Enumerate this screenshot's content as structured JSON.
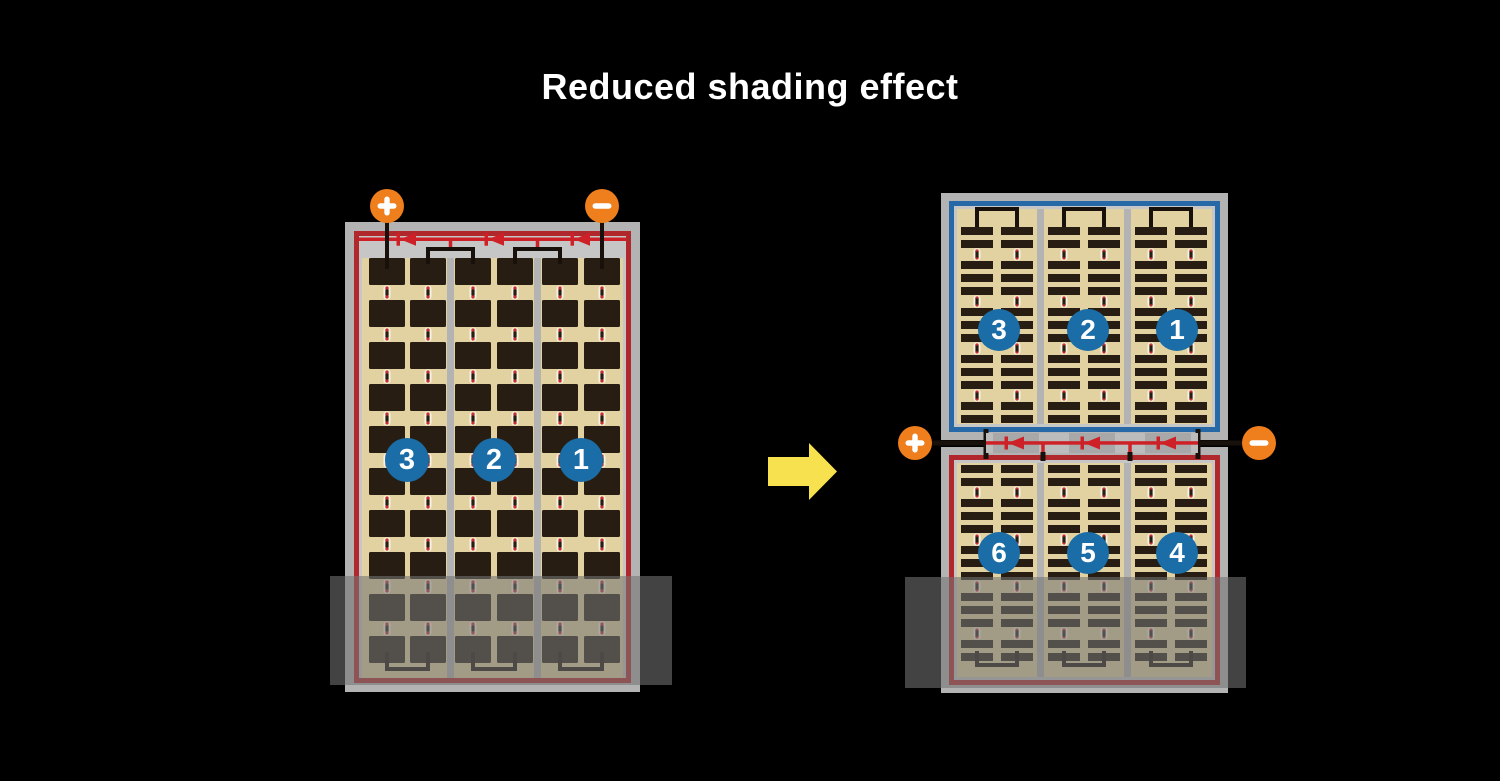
{
  "title": "Reduced shading effect",
  "left_module": {
    "terminals": {
      "positive": "+",
      "negative": "−"
    },
    "cell_strings": [
      "3",
      "2",
      "1"
    ],
    "grid": {
      "columns": 6,
      "rows": 10
    },
    "bypass_diodes": 3,
    "shaded_lower_area": true
  },
  "transition": {
    "arrow_direction": "right"
  },
  "right_module": {
    "terminals": {
      "positive": "+",
      "negative": "−"
    },
    "top_half": {
      "cell_strings": [
        "3",
        "2",
        "1"
      ],
      "border": "blue"
    },
    "bottom_half": {
      "cell_strings": [
        "6",
        "5",
        "4"
      ],
      "border": "red"
    },
    "bypass_diodes": 3,
    "shaded_lower_area": true
  },
  "colors": {
    "background": "#000000",
    "title_text": "#ffffff",
    "frame_gray": "#b3b3b3",
    "inner_gray": "#c6c6c6",
    "strip_gray": "#bcbcbc",
    "diode_block_gray": "#a8a8a8",
    "cell_field_tan": "#e3d2a1",
    "cell_dark": "#281d12",
    "border_red": "#b0282c",
    "border_blue": "#2769a6",
    "wire_black": "#18100a",
    "diode_red": "#cd2127",
    "terminal_orange": "#ee7f1c",
    "badge_blue": "#1a6da6",
    "pill_white": "#f7f2e4",
    "pill_dot_red": "#c6312e",
    "arrow_yellow": "#f7e14e",
    "shade": "rgba(115,115,115,0.58)"
  }
}
